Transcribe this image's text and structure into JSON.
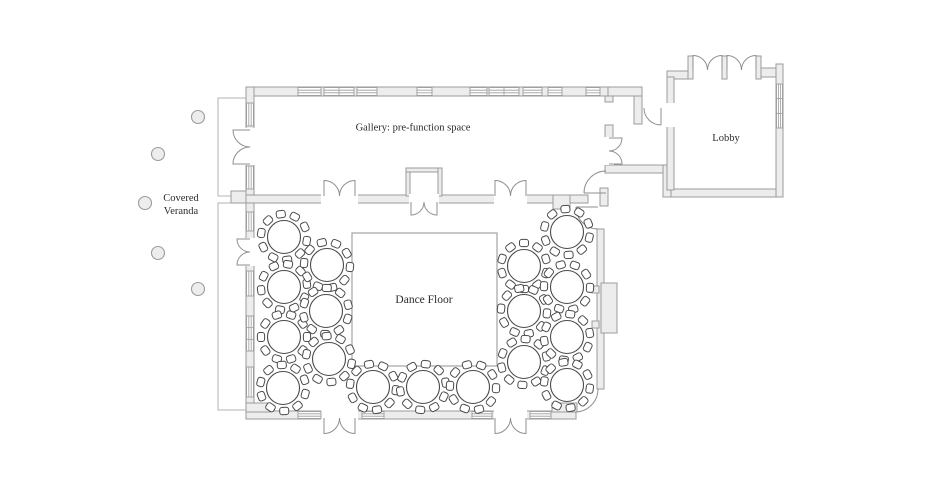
{
  "palette": {
    "background": "#ffffff",
    "wall_fill": "#ededed",
    "wall_stroke": "#9b9b9b",
    "thin_outline": "#b3b3b3",
    "door_stroke": "#8f8f8f",
    "furniture_stroke": "#4a4a4a",
    "furniture_fill": "#ffffff",
    "dance_floor_stroke": "#aaaaaa",
    "text_color": "#2b2b2b"
  },
  "labels": {
    "gallery": "Gallery: pre-function space",
    "lobby": "Lobby",
    "veranda_line1": "Covered",
    "veranda_line2": "Veranda",
    "dance_floor": "Dance Floor"
  },
  "floor_plan": {
    "rooms": [
      {
        "id": "gallery",
        "label": "Gallery: pre-function space"
      },
      {
        "id": "lobby",
        "label": "Lobby"
      },
      {
        "id": "covered-veranda",
        "label": "Covered Veranda"
      },
      {
        "id": "ballroom",
        "label": ""
      }
    ],
    "dance_floor": {
      "x": 352,
      "y": 233,
      "width": 145,
      "height": 133
    },
    "tables": {
      "count": 17,
      "seats_per_table": 10,
      "table_radius": 16.5,
      "positions": [
        [
          284,
          237
        ],
        [
          284,
          287
        ],
        [
          284,
          337
        ],
        [
          283,
          388
        ],
        [
          327,
          265
        ],
        [
          326,
          311
        ],
        [
          329,
          359
        ],
        [
          373,
          387
        ],
        [
          423,
          387
        ],
        [
          473,
          387
        ],
        [
          524,
          266
        ],
        [
          524,
          311
        ],
        [
          524,
          362
        ],
        [
          567,
          232
        ],
        [
          567,
          287
        ],
        [
          567,
          337
        ],
        [
          567,
          385
        ]
      ]
    },
    "veranda_columns": {
      "count": 5,
      "radius": 6.5,
      "positions": [
        [
          198,
          117
        ],
        [
          158,
          154
        ],
        [
          145,
          203
        ],
        [
          158,
          253
        ],
        [
          198,
          289
        ]
      ]
    }
  }
}
